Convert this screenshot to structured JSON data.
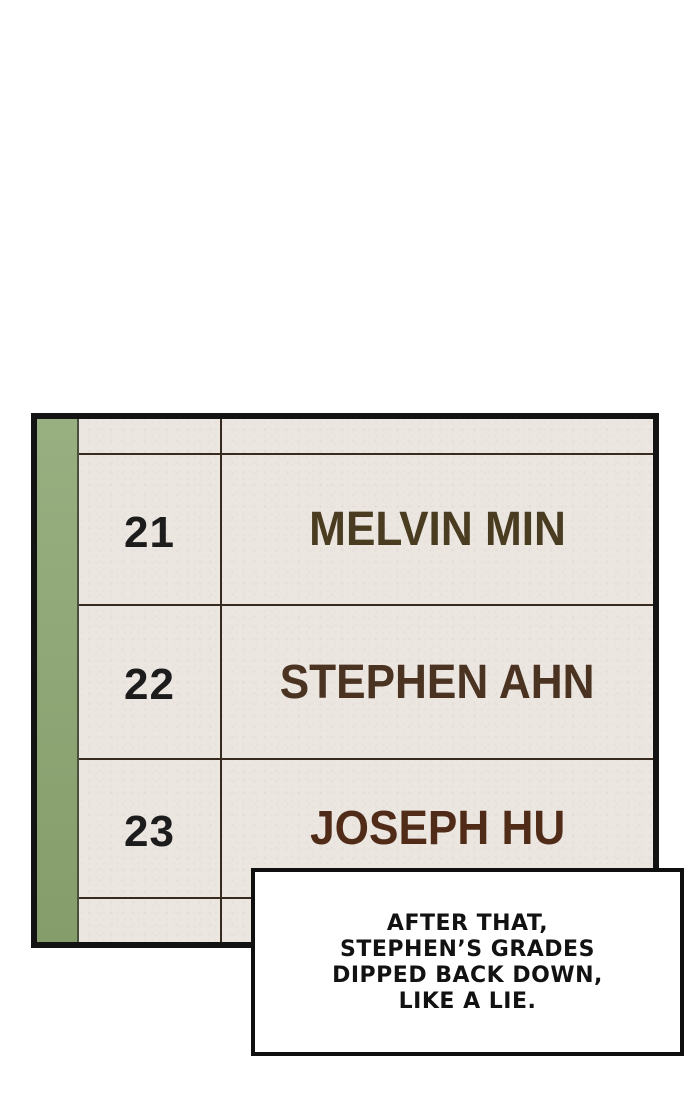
{
  "page": {
    "background": "#ffffff"
  },
  "panel": {
    "kind": "class-rank-roster",
    "paper_color": "#ece6e1",
    "border_color": "#131313",
    "grid_line_color": "#362b1e",
    "spine_color_top": "#98b081",
    "spine_color_bottom": "#859d6a",
    "rank_color": "#1c1c1c",
    "rows": [
      {
        "rank": "21",
        "name": "MELVIN MIN",
        "name_color": "#4a3c20"
      },
      {
        "rank": "22",
        "name": "STEPHEN AHN",
        "name_color": "#4b3322"
      },
      {
        "rank": "23",
        "name": "JOSEPH HU",
        "name_color": "#502c18"
      }
    ]
  },
  "caption": {
    "lines": [
      "AFTER THAT,",
      "STEPHEN’S GRADES",
      "DIPPED BACK DOWN,",
      "LIKE A LIE."
    ],
    "text_color": "#121212",
    "background": "#ffffff",
    "border_color": "#0f0f0f"
  }
}
